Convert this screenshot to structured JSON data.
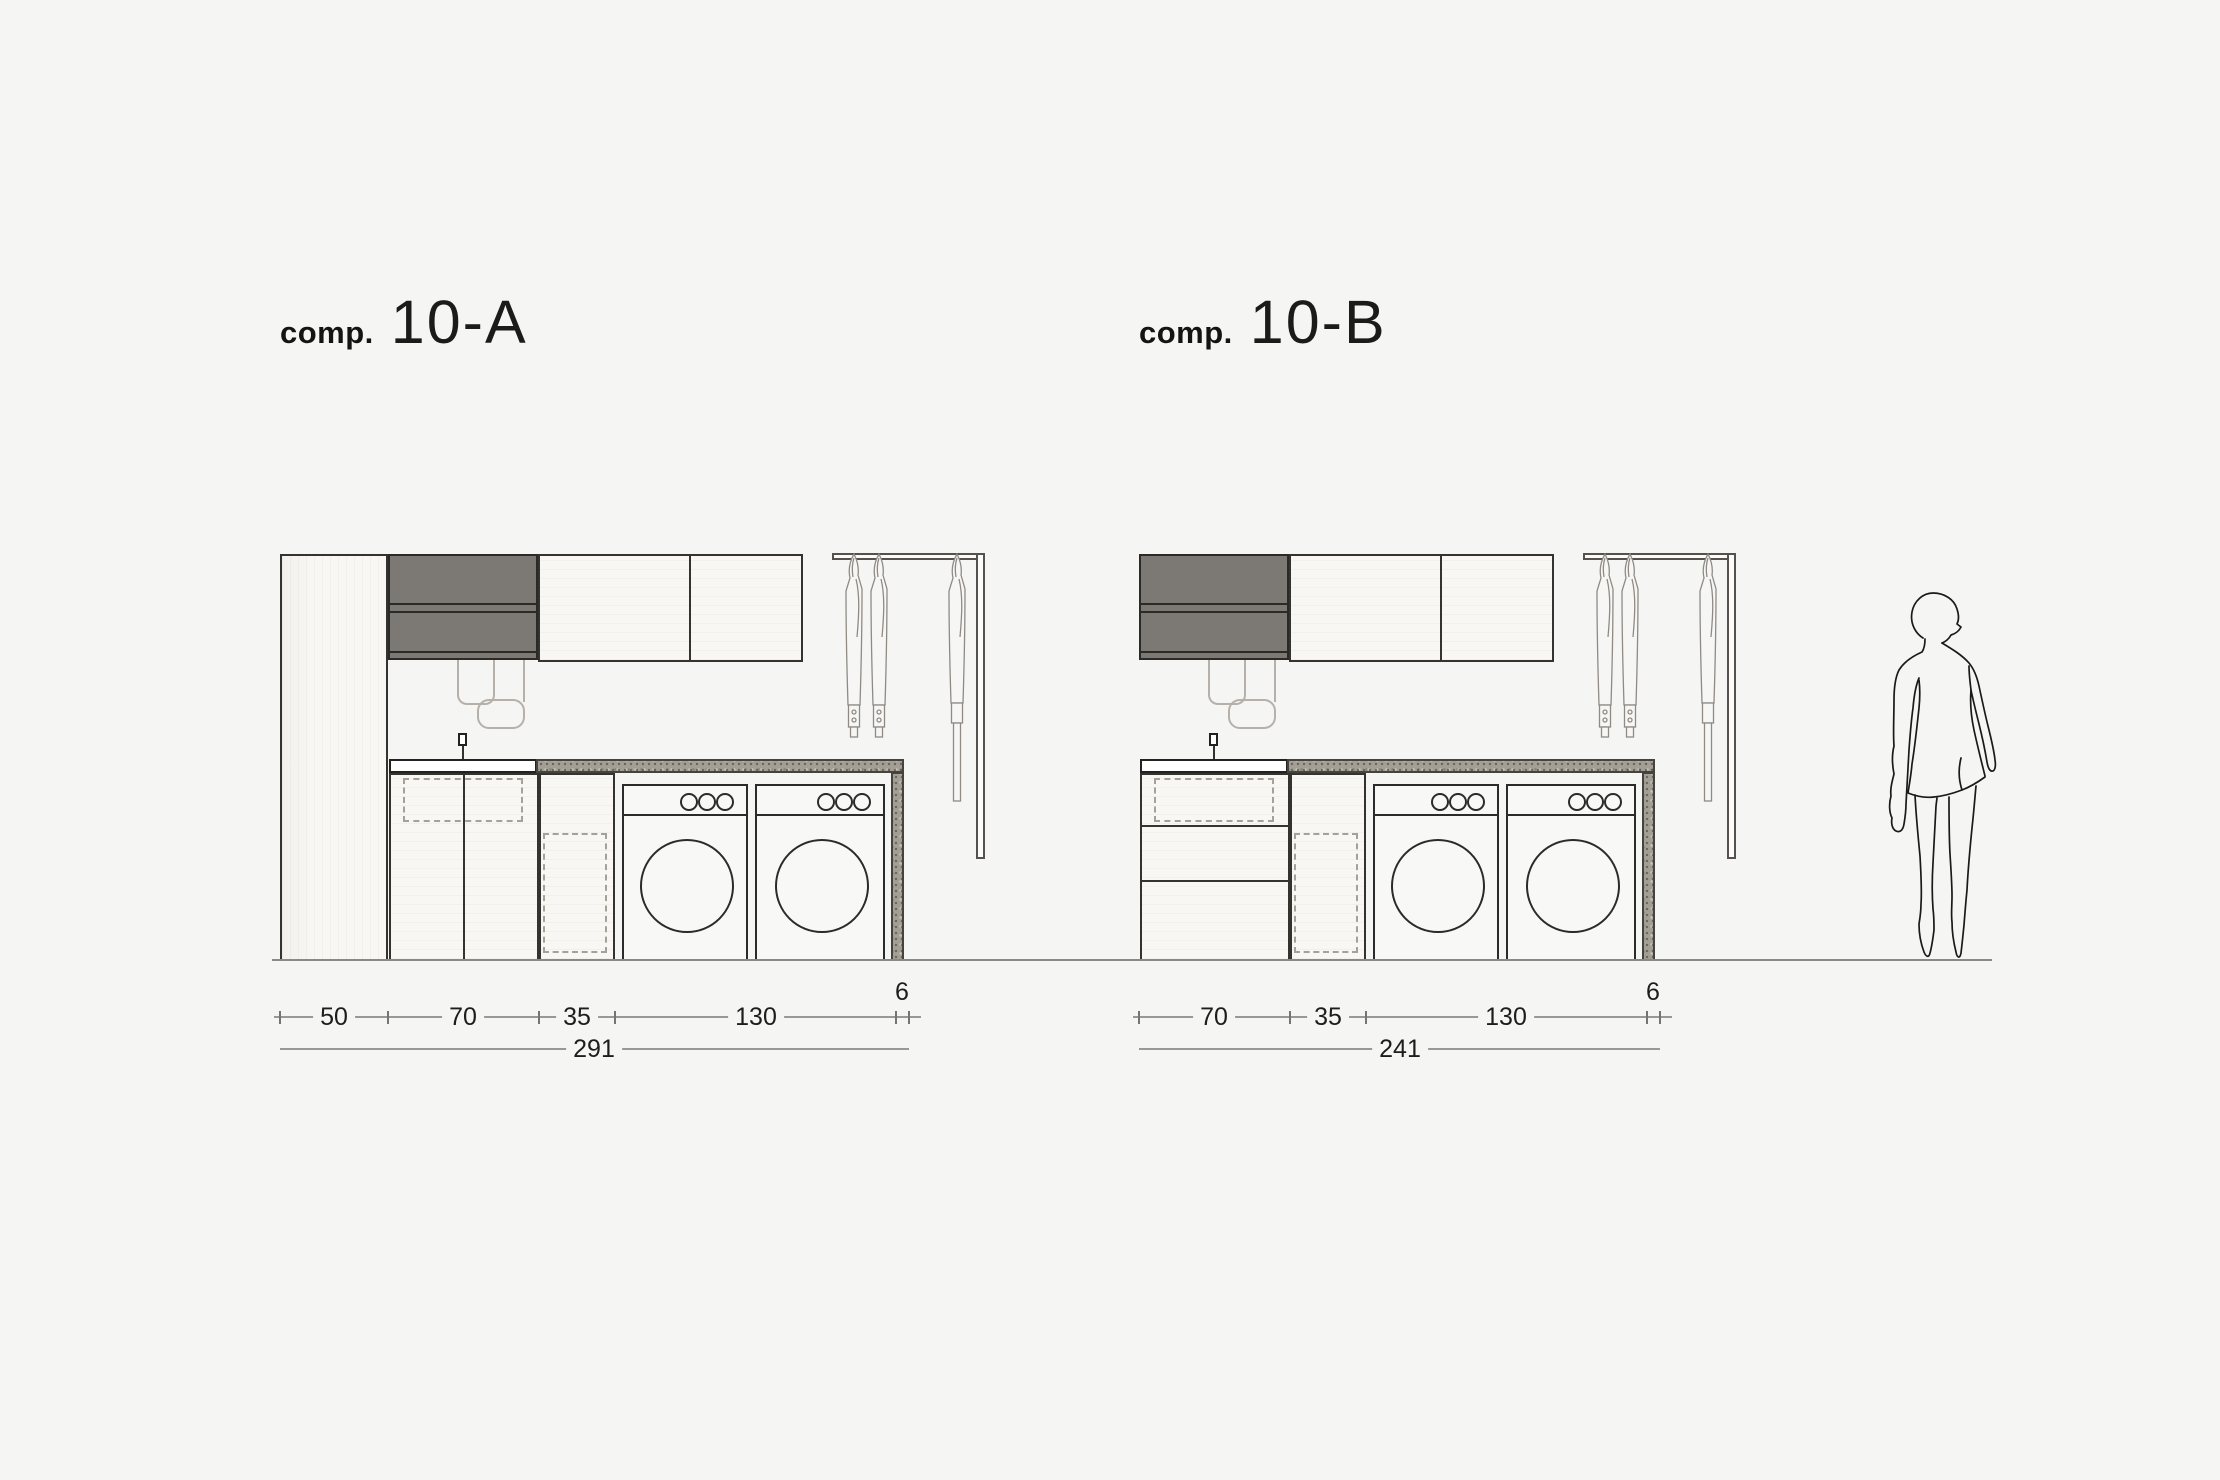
{
  "page": {
    "background": "#f5f5f4",
    "colors": {
      "dark_cabinet": "#7c7873",
      "countertop": "#a39f95",
      "line": "#2b2b29"
    }
  },
  "compositions": [
    {
      "id": "A",
      "title": {
        "prefix": "comp.",
        "name": "10-A"
      },
      "dims": {
        "segments": [
          "50",
          "70",
          "35",
          "130",
          "6"
        ],
        "total": "291"
      }
    },
    {
      "id": "B",
      "title": {
        "prefix": "comp.",
        "name": "10-B"
      },
      "dims": {
        "segments": [
          "70",
          "35",
          "130",
          "6"
        ],
        "total": "241"
      }
    }
  ]
}
